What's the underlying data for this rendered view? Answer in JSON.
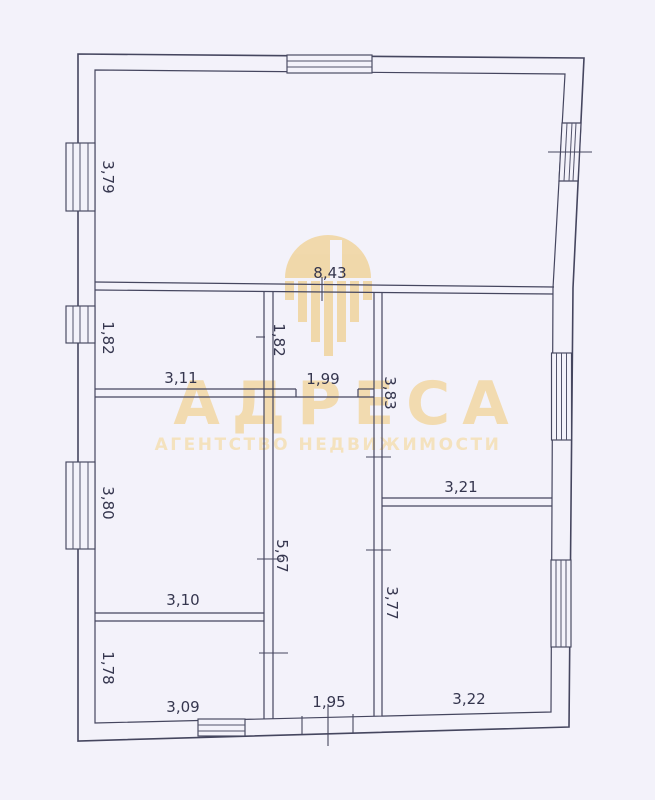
{
  "watermark": {
    "brand": "АДРЕСА",
    "tagline": "АГЕНТСТВО НЕДВИЖИМОСТИ",
    "brand_color": "#f2d8a6"
  },
  "colors": {
    "paper": "#f3f2fa",
    "line": "#45465f",
    "dimension_text": "#35364e",
    "watermark": "#f0d5a0"
  },
  "dimension_labels": {
    "top_room_height": "3,79",
    "top_room_width": "8,43",
    "hall_left_height": "1,82",
    "hall_mid_height": "1,82",
    "hall_width": "3,11",
    "corridor_top_width": "1,99",
    "right_upper_room_height": "3,83",
    "left_mid_room_height": "3,80",
    "right_lower_room_width": "3,21",
    "corridor_height": "5,67",
    "left_lower_room_width": "3,10",
    "right_lower_room_height": "3,77",
    "bottom_left_room_height": "1,78",
    "bottom_left_room_width": "3,09",
    "corridor_bottom_width": "1,95",
    "bottom_right_room_width": "3,22"
  }
}
